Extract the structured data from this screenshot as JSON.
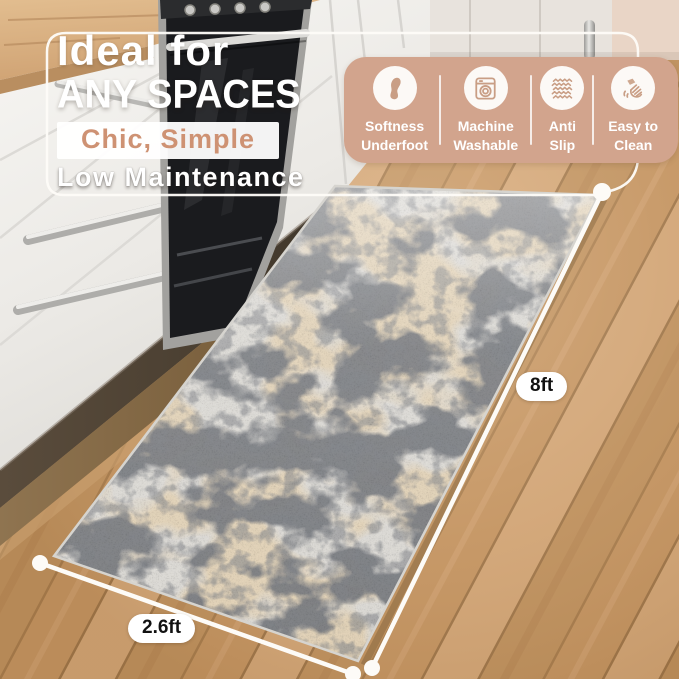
{
  "headline": {
    "script": "Ideal for",
    "main": "ANY SPACES",
    "accent": "Chic, Simple",
    "sub": "Low Maintenance"
  },
  "features": [
    {
      "icon": "foot-icon",
      "line1": "Softness",
      "line2": "Underfoot"
    },
    {
      "icon": "washing-machine-icon",
      "line1": "Machine",
      "line2": "Washable"
    },
    {
      "icon": "anti-slip-icon",
      "line1": "Anti",
      "line2": "Slip"
    },
    {
      "icon": "hand-wipe-icon",
      "line1": "Easy to",
      "line2": "Clean"
    }
  ],
  "dimensions": {
    "length_label": "8ft",
    "width_label": "2.6ft"
  },
  "colors": {
    "banner_bg": "#d2a48d",
    "accent_text": "#ce9273",
    "headline_text": "#ffffff",
    "badge_bg": "#ffffff",
    "badge_text": "#111111",
    "measure_line": "#fdfbf7",
    "rug_base": "#dfddd8",
    "rug_dark": "#33363a",
    "rug_tan": "#c7a675",
    "floor_wood": "#c79a6c"
  }
}
